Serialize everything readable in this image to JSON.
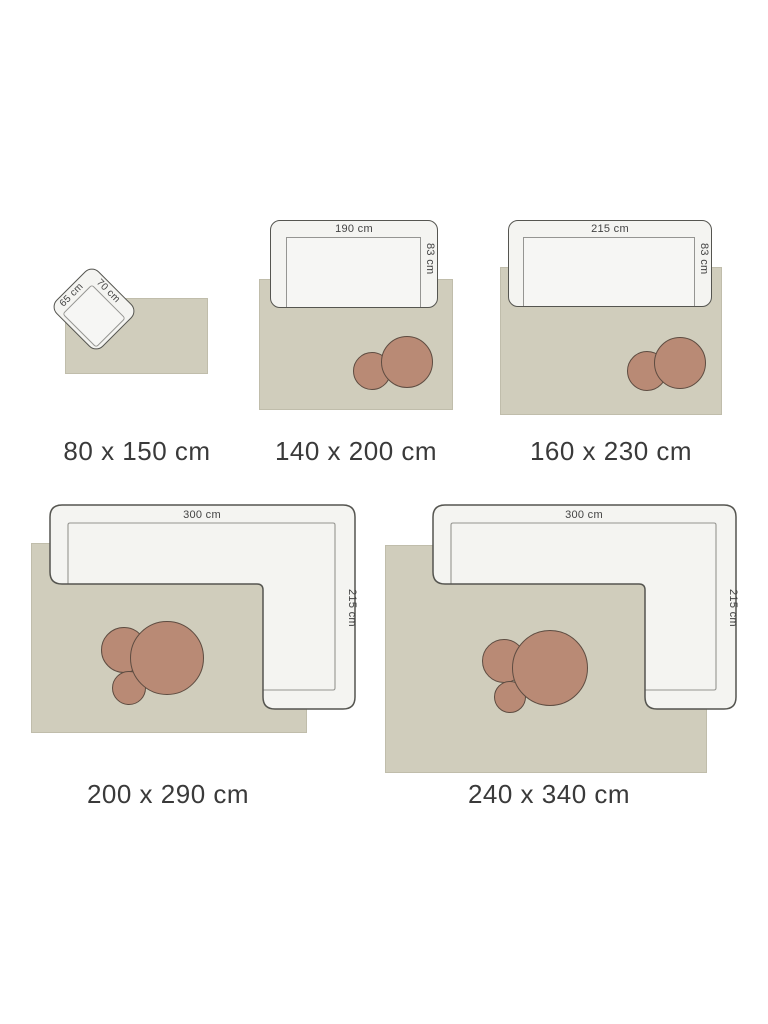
{
  "page": {
    "description": "Rug size guide with furniture for scale"
  },
  "colors": {
    "background": "#ffffff",
    "rug_fill": "#d0cdbc",
    "rug_border": "#c0bdab",
    "furniture_fill": "#f4f4f1",
    "furniture_stroke": "#555550",
    "table_fill": "#b98a75",
    "table_stroke": "#5e4c41",
    "size_label_color": "#3a3a3a",
    "dim_label_color": "#434343"
  },
  "diagrams": [
    {
      "id": "rug-80x150",
      "size_label": "80 x 150 cm",
      "furniture": {
        "type": "chair",
        "width_label": "65 cm",
        "depth_label": "70 cm"
      }
    },
    {
      "id": "rug-140x200",
      "size_label": "140 x 200 cm",
      "furniture": {
        "type": "sofa",
        "width_label": "190 cm",
        "depth_label": "83 cm"
      },
      "tables": 2
    },
    {
      "id": "rug-160x230",
      "size_label": "160 x 230 cm",
      "furniture": {
        "type": "sofa",
        "width_label": "215 cm",
        "depth_label": "83 cm"
      },
      "tables": 2
    },
    {
      "id": "rug-200x290",
      "size_label": "200 x 290 cm",
      "furniture": {
        "type": "corner-sofa",
        "width_label": "300 cm",
        "depth_label": "215 cm"
      },
      "tables": 3
    },
    {
      "id": "rug-240x340",
      "size_label": "240 x 340 cm",
      "furniture": {
        "type": "corner-sofa",
        "width_label": "300 cm",
        "depth_label": "215 cm"
      },
      "tables": 3
    }
  ]
}
